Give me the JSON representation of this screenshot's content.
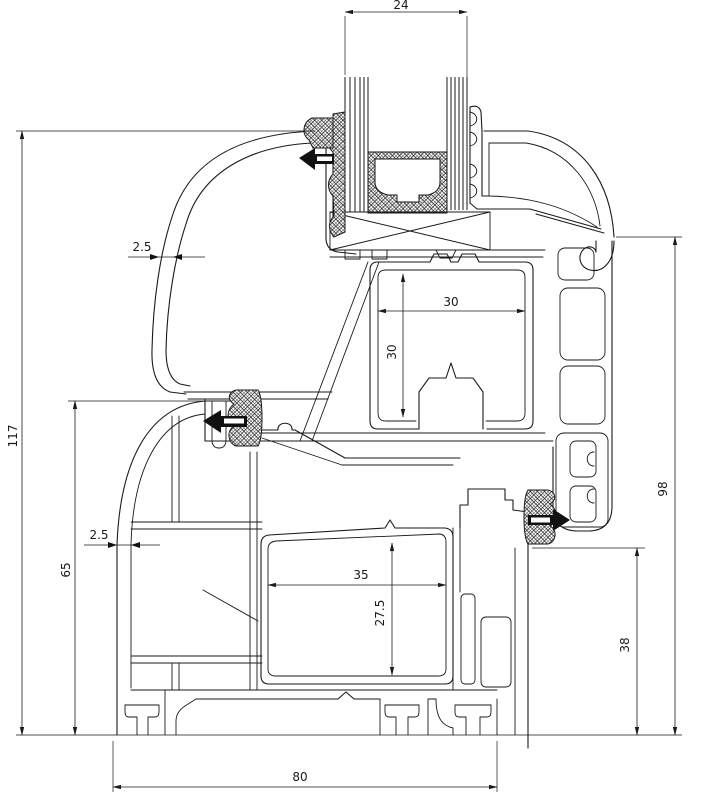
{
  "drawing": {
    "title": "window-profile-cross-section",
    "description": "Technical CAD cross section of a PVC window frame and sash with insulated glazing unit, gaskets and steel reinforcement chambers",
    "line_color": "#1a1a1a",
    "background_color": "#ffffff",
    "dimensions": {
      "glass_unit_thickness": "24",
      "total_height": "117",
      "frame_left_height": "65",
      "bead_wall_thickness": "2.5",
      "frame_wall_thickness": "2.5",
      "sash_steel_width": "30",
      "sash_steel_height": "30",
      "frame_steel_width": "35",
      "frame_steel_height": "27.5",
      "frame_face_height": "38",
      "sash_exterior_height": "98",
      "frame_overall_width": "80"
    }
  }
}
